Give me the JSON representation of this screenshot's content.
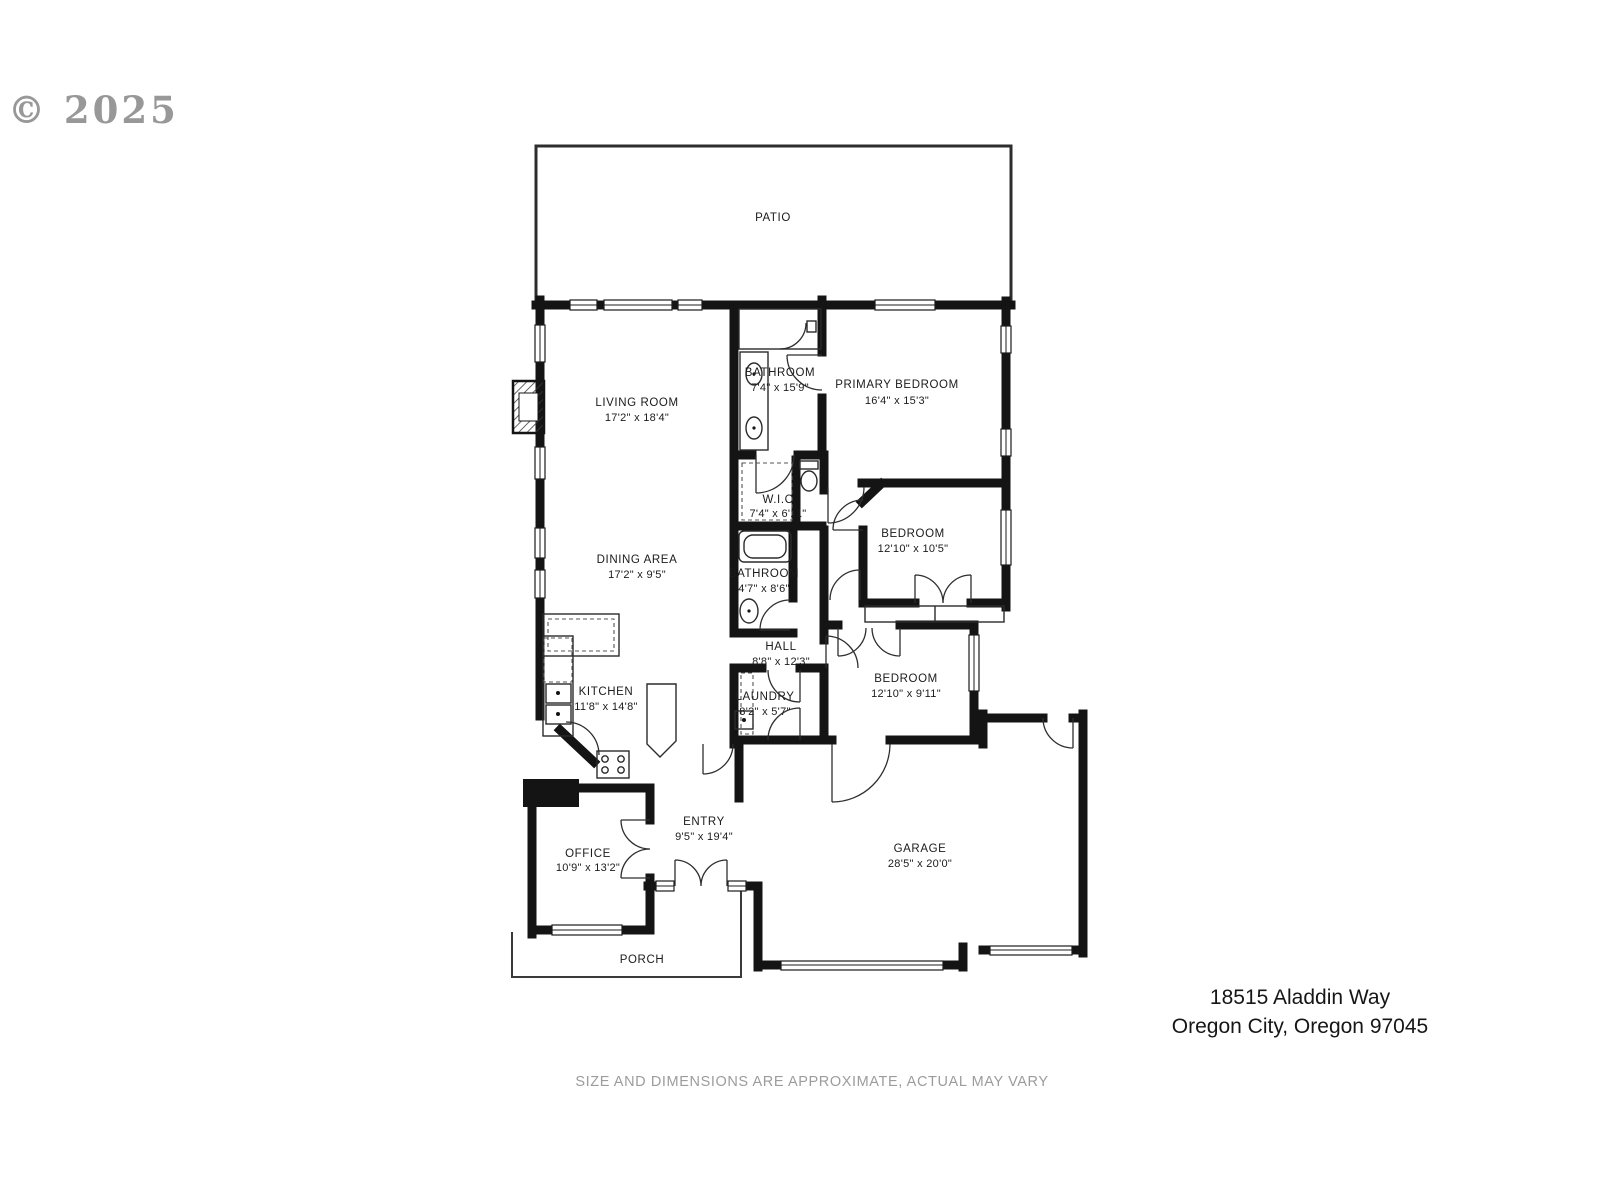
{
  "watermark": "© 2025",
  "address": {
    "line1": "18515 Aladdin Way",
    "line2": "Oregon City, Oregon 97045"
  },
  "disclaimer": "SIZE AND DIMENSIONS ARE APPROXIMATE, ACTUAL MAY VARY",
  "colors": {
    "wall": "#141414",
    "label": "#1b1b1b",
    "watermark_gray": "#8d8d8d",
    "disclaimer_gray": "#9c9c9c"
  },
  "rooms": {
    "patio": {
      "name": "PATIO",
      "dims": ""
    },
    "living_room": {
      "name": "LIVING ROOM",
      "dims": "17'2\" x 18'4\""
    },
    "bathroom_primary": {
      "name": "BATHROOM",
      "dims": "7'4\" x 15'9\""
    },
    "primary_bedroom": {
      "name": "PRIMARY BEDROOM",
      "dims": "16'4\" x 15'3\""
    },
    "wic": {
      "name": "W.I.C",
      "dims": "7'4\" x 6'11\""
    },
    "dining_area": {
      "name": "DINING AREA",
      "dims": "17'2\" x 9'5\""
    },
    "bathroom_hall": {
      "name": "BATHROOM",
      "dims": "4'7\" x 8'6\""
    },
    "bedroom_one": {
      "name": "BEDROOM",
      "dims": "12'10\" x 10'5\""
    },
    "hall": {
      "name": "HALL",
      "dims": "8'8\" x 12'3\""
    },
    "bedroom_two": {
      "name": "BEDROOM",
      "dims": "12'10\" x 9'11\""
    },
    "kitchen": {
      "name": "KITCHEN",
      "dims": "11'8\" x 14'8\""
    },
    "laundry": {
      "name": "LAUNDRY",
      "dims": "8'2\" x 5'7\""
    },
    "office": {
      "name": "OFFICE",
      "dims": "10'9\" x 13'2\""
    },
    "entry": {
      "name": "ENTRY",
      "dims": "9'5\" x 19'4\""
    },
    "garage": {
      "name": "GARAGE",
      "dims": "28'5\" x 20'0\""
    },
    "porch": {
      "name": "PORCH",
      "dims": ""
    }
  }
}
